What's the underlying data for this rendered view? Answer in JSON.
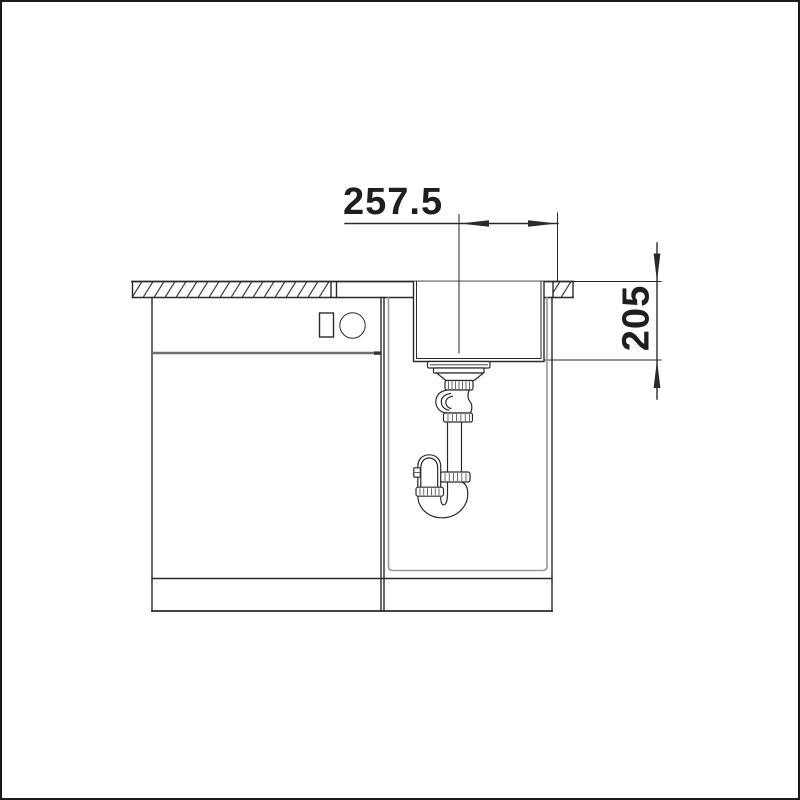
{
  "drawing": {
    "kind": "sink-cabinet-installation-section",
    "dimensions": {
      "horizontal": {
        "label": "257.5"
      },
      "vertical": {
        "label": "205"
      }
    },
    "colors": {
      "line": "#2a2a2a",
      "light_line": "#9a9a9a",
      "divider": "#6e6e6e",
      "frame": "#1a1a1a",
      "background": "#ffffff"
    }
  }
}
